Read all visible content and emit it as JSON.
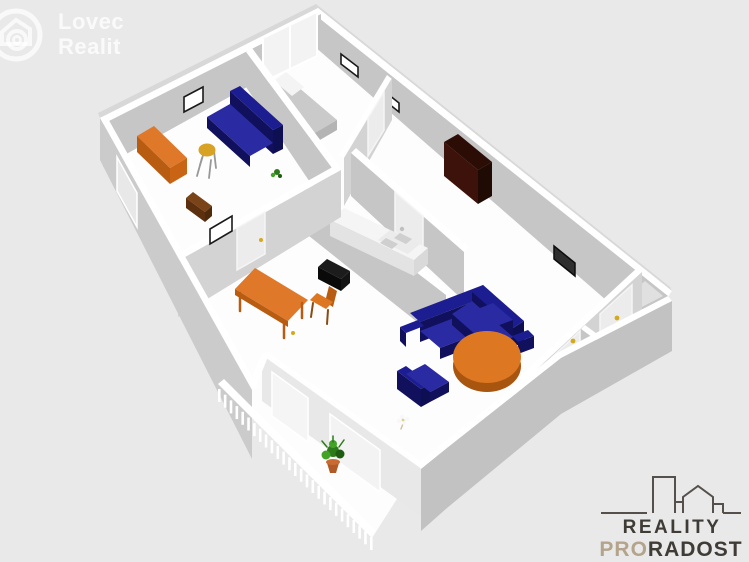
{
  "watermark": {
    "line1": "Lovec",
    "line2": "Realit"
  },
  "footer_logo": {
    "line1": "REALITY",
    "line2_accent": "PRO",
    "line2_rest": "RADOST"
  },
  "scene": {
    "type": "3d-floorplan-render",
    "items": [
      "sofa",
      "bed",
      "pillow",
      "wardrobe",
      "corner-sofa",
      "armchair",
      "coffee-table",
      "bench",
      "dining-table",
      "dining-chair",
      "stool",
      "sideboard",
      "side-table",
      "kitchen-counter",
      "sink",
      "stove",
      "tv",
      "picture-frame",
      "window",
      "door",
      "glass-wall",
      "balcony-railing",
      "potted-plant",
      "small-plant",
      "flower",
      "bowl"
    ]
  },
  "colors": {
    "background": "#e9e9e9",
    "floor": "#fdfdfd",
    "wallTop": "#ffffff",
    "faceDark": "#c6c6c6",
    "faceLight": "#d3d3d3",
    "outerSW": "#cbcbcb",
    "outerSE": "#c2c2c2",
    "outerStripe": "#d8d8d8",
    "glass": "#f3f3f3",
    "glassFace": "#e8e8e8",
    "panel": "#ececec",
    "panelLight": "#f5f5f5",
    "closetFloor": "#e0e0e0",
    "navy": "#1d1d92",
    "navyDark": "#10105c",
    "navyDeep": "#0e0e52",
    "navySeat": "#2a2aa2",
    "orange": "#e0782a",
    "orangeDark": "#b85c12",
    "orangeEnd": "#c96414",
    "orangeTable": "#dd7722",
    "orangeTableDark": "#a85510",
    "benchEnd": "#964a0e",
    "yellowSeat": "#d8a224",
    "stoolBack": "#c89018",
    "woodBrown": "#7a4418",
    "woodBrownDark": "#5c300e",
    "woodBrownEnd": "#4e2a0c",
    "wardrobe": "#2c0d06",
    "wardrobeSide": "#3c120a",
    "wardrobeEnd": "#1f0a04",
    "bedGray": "#cacaca",
    "bedGraySide": "#a8a8a8",
    "bedGrayEnd": "#b4b4b4",
    "pillow": "#f4f4f4",
    "black": "#1c1c1c",
    "blackDeep": "#0a0a0a",
    "blackMid": "#141414",
    "tvDark": "#2e2e2e",
    "tvStroke": "#0d0d0d",
    "frameStroke": "#1a1a1a",
    "green": "#2d7a1a",
    "greenLight": "#43a327",
    "greenDark": "#1e5c12",
    "pot": "#b05a28",
    "potRim": "#c96a32",
    "handle": "#d4a91c",
    "purple": "#5c2d8e",
    "purpleDeep": "#2a1244",
    "stem": "#cfc49a",
    "petal": "#f8f8f8",
    "petalCenter": "#e0d090",
    "counterTop": "#f5f5f5",
    "counterFace": "#e3e3e3",
    "counterEnd": "#d9d9d9",
    "sinkTop": "#ebebeb",
    "basin": "#cfcfcf",
    "faucet": "#c0c0c0",
    "legGray": "#989898",
    "legOrange": "#8a4a10",
    "watermark": "rgba(255,255,255,0.78)",
    "logoDark": "#3f3b37",
    "logoTan": "#b5a48c",
    "logoLine": "#55504b"
  }
}
